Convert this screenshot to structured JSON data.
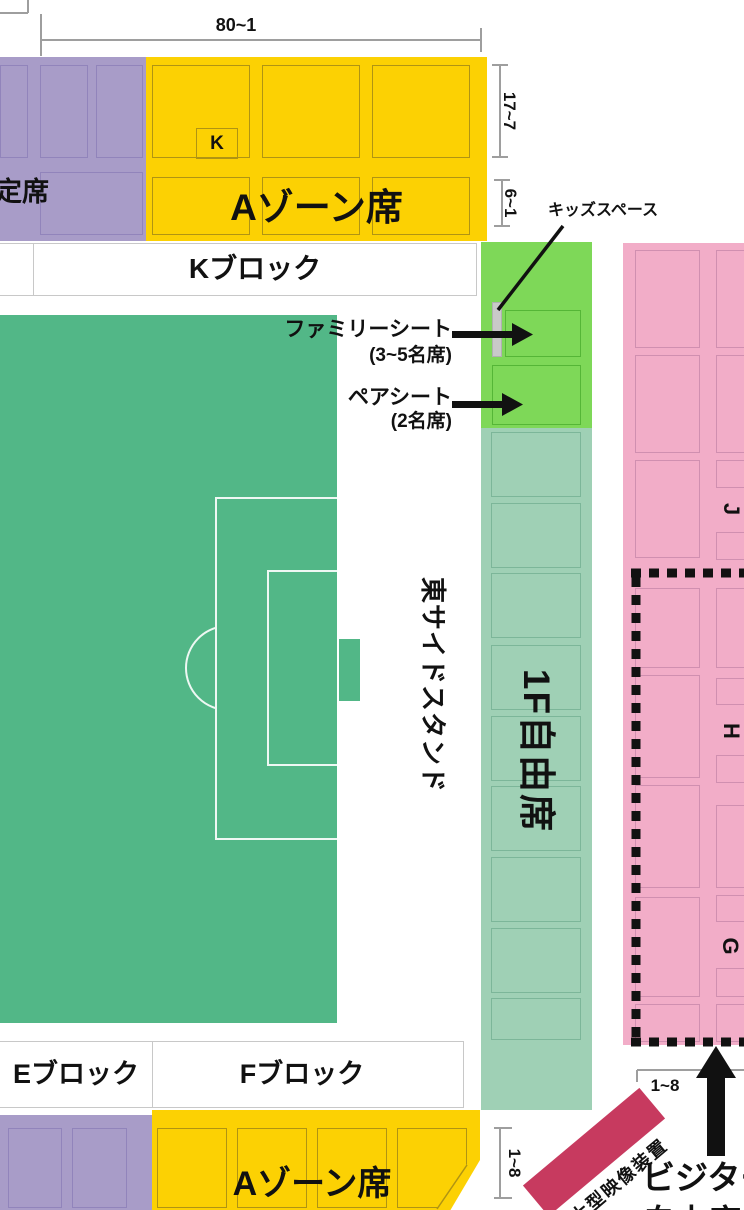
{
  "zones": {
    "purple_top": {
      "label": "定席"
    },
    "a_zone_top": {
      "label": "Aゾーン席",
      "block_letter": "K"
    },
    "k_block_strip": {
      "label": "Kブロック"
    },
    "kids_space": {
      "label": "キッズスペース"
    },
    "family_seat": {
      "label": "ファミリーシート",
      "capacity": "(3~5名席)"
    },
    "pair_seat": {
      "label": "ペアシート",
      "capacity": "(2名席)"
    },
    "east_stand": {
      "label": "東サイドスタンド"
    },
    "free_seat_1f": {
      "label": "1F自由席"
    },
    "pink_stand": {
      "row_labels": [
        "J",
        "H",
        "G"
      ]
    },
    "e_block": {
      "label": "Eブロック"
    },
    "f_block": {
      "label": "Fブロック"
    },
    "a_zone_bottom": {
      "label": "Aゾーン席"
    },
    "video_board": {
      "label": "大型映像装置"
    },
    "visitor": {
      "line1": "ビジター",
      "line2": "自由席"
    }
  },
  "brackets": {
    "top": "80~1",
    "right_upper": "17~7",
    "right_lower": "6~1",
    "bottom_left": "1~8",
    "bottom_pink": "1~8"
  },
  "colors": {
    "field-green": "#52b787",
    "zone-yellow": "#fcd103",
    "yellow-border": "#b09413",
    "zone-purple": "#a89cc8",
    "purple-border": "#9184bb",
    "zone-green": "#7ed858",
    "green-border": "#55b637",
    "zone-teal": "#9fd0b5",
    "teal-border": "#7cb699",
    "zone-pink": "#f2adc8",
    "pink-border": "#d08fb0",
    "ribbon-red": "#c73a5f",
    "kids-gray": "#c9c9c9",
    "bracket-gray": "#9e9e9e",
    "strip-border": "#c8c8c8",
    "ink": "#111111"
  }
}
